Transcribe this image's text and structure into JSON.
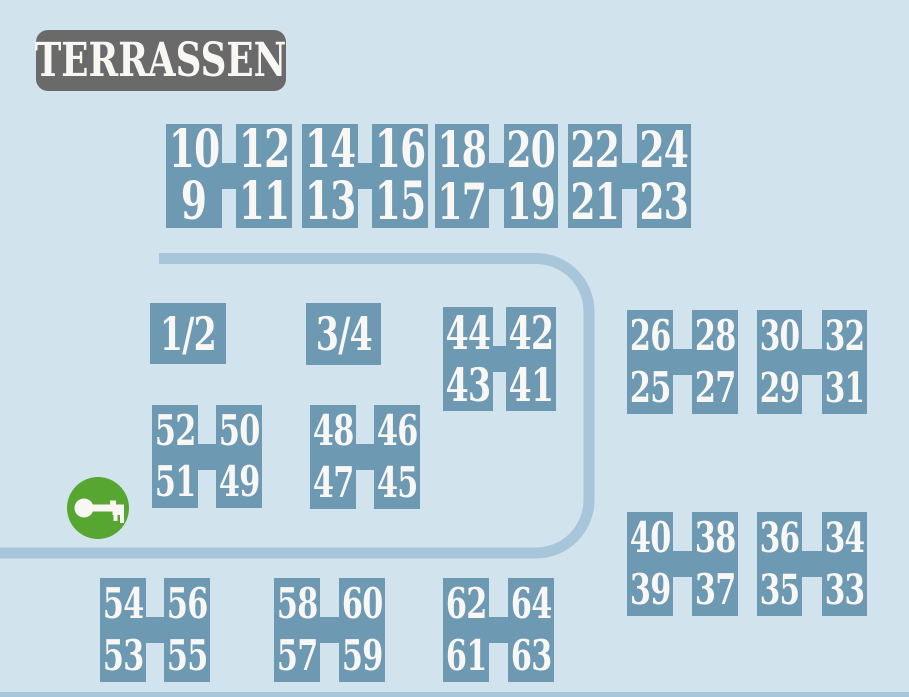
{
  "header": {
    "title": "TERRASSEN"
  },
  "colors": {
    "background": "#D1E3ED",
    "block": "#6E99B3",
    "road": "#A8C6D9",
    "header_bg": "#6A6A6A",
    "number_text": "#F8F7F4",
    "key_green": "#57A631"
  },
  "key_marker": {
    "icon": "key-icon"
  },
  "road": {
    "path": "M 159 258.5 H 536 A 53 53 0 0 1 589 311.5 V 500 A 53 53 0 0 1 536 553 H 0",
    "stroke_width": 11,
    "bottom_strip": true
  },
  "single_cells": [
    {
      "label": "1/2",
      "x": 150,
      "y": 303,
      "w": 76,
      "h": 61
    },
    {
      "label": "3/4",
      "x": 306,
      "y": 303,
      "w": 75,
      "h": 62
    }
  ],
  "h_blocks": [
    {
      "name": "9-12",
      "x": 166,
      "y": 124,
      "colW": 56,
      "gap": 14,
      "h": 104,
      "top": [
        "10",
        "12"
      ],
      "bottom": [
        "9",
        "11"
      ]
    },
    {
      "name": "13-16",
      "x": 302,
      "y": 124,
      "colW": 56,
      "gap": 14,
      "h": 104,
      "top": [
        "14",
        "16"
      ],
      "bottom": [
        "13",
        "15"
      ]
    },
    {
      "name": "17-20",
      "x": 435,
      "y": 124,
      "colW": 54,
      "gap": 15,
      "h": 104,
      "top": [
        "18",
        "20"
      ],
      "bottom": [
        "17",
        "19"
      ]
    },
    {
      "name": "21-24",
      "x": 568,
      "y": 124,
      "colW": 54,
      "gap": 15,
      "h": 104,
      "top": [
        "22",
        "24"
      ],
      "bottom": [
        "21",
        "23"
      ]
    },
    {
      "name": "41-44",
      "x": 443,
      "y": 307,
      "colW": 50,
      "gap": 13,
      "h": 104,
      "top": [
        "44",
        "42"
      ],
      "bottom": [
        "43",
        "41"
      ]
    },
    {
      "name": "25-28",
      "x": 627,
      "y": 310,
      "colW": 46,
      "gap": 19,
      "h": 104,
      "top": [
        "26",
        "28"
      ],
      "bottom": [
        "25",
        "27"
      ]
    },
    {
      "name": "29-32",
      "x": 757,
      "y": 310,
      "colW": 45,
      "gap": 20,
      "h": 104,
      "top": [
        "30",
        "32"
      ],
      "bottom": [
        "29",
        "31"
      ]
    },
    {
      "name": "49-52",
      "x": 152,
      "y": 405,
      "colW": 46,
      "gap": 18,
      "h": 103,
      "top": [
        "52",
        "50"
      ],
      "bottom": [
        "51",
        "49"
      ]
    },
    {
      "name": "45-48",
      "x": 310,
      "y": 405,
      "colW": 46,
      "gap": 18,
      "h": 104,
      "top": [
        "48",
        "46"
      ],
      "bottom": [
        "47",
        "45"
      ]
    },
    {
      "name": "37-40",
      "x": 627,
      "y": 512,
      "colW": 46,
      "gap": 19,
      "h": 104,
      "top": [
        "40",
        "38"
      ],
      "bottom": [
        "39",
        "37"
      ]
    },
    {
      "name": "33-36",
      "x": 757,
      "y": 512,
      "colW": 45,
      "gap": 20,
      "h": 104,
      "top": [
        "36",
        "34"
      ],
      "bottom": [
        "35",
        "33"
      ]
    },
    {
      "name": "53-56",
      "x": 100,
      "y": 578,
      "colW": 46,
      "gap": 18,
      "h": 104,
      "top": [
        "54",
        "56"
      ],
      "bottom": [
        "53",
        "55"
      ]
    },
    {
      "name": "57-60",
      "x": 274,
      "y": 578,
      "colW": 46,
      "gap": 19,
      "h": 104,
      "top": [
        "58",
        "60"
      ],
      "bottom": [
        "57",
        "59"
      ]
    },
    {
      "name": "61-64",
      "x": 443,
      "y": 578,
      "colW": 46,
      "gap": 19,
      "h": 104,
      "top": [
        "62",
        "64"
      ],
      "bottom": [
        "61",
        "63"
      ]
    }
  ]
}
